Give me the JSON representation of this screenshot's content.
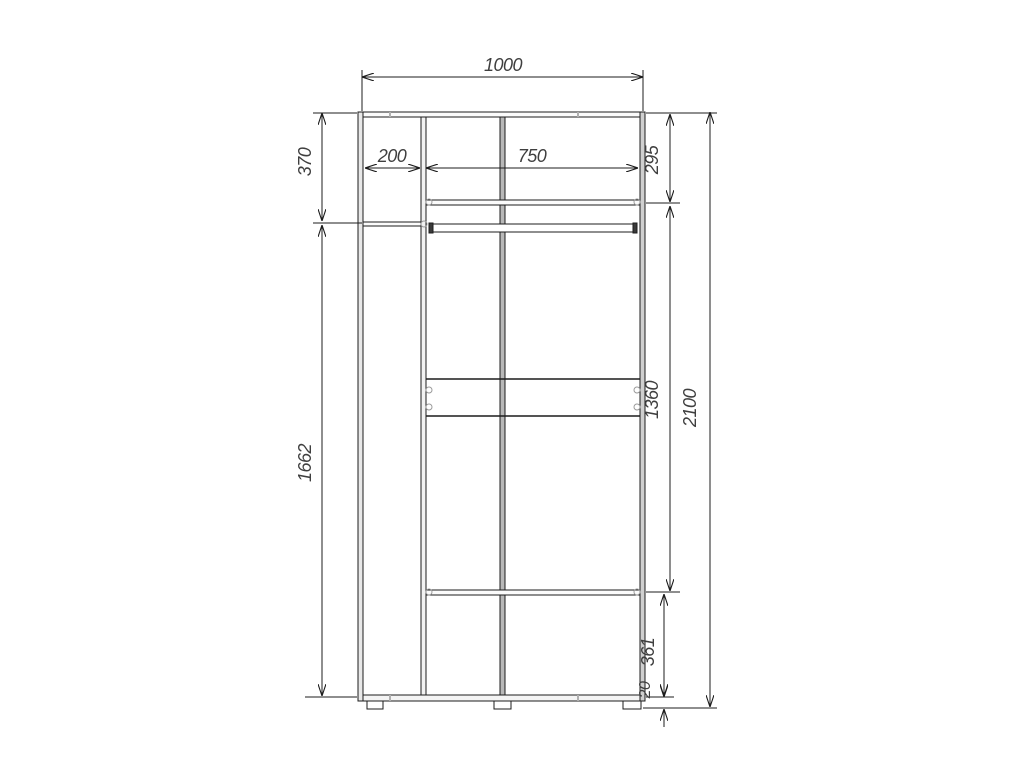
{
  "drawing": {
    "type": "wardrobe-front-section-technical-drawing",
    "dimensions": {
      "width_total": {
        "label": "1000"
      },
      "left_section_width": {
        "label": "200"
      },
      "right_section_width": {
        "label": "750"
      },
      "top_left_height": {
        "label": "370"
      },
      "top_right_height": {
        "label": "295"
      },
      "left_lower_height": {
        "label": "1662"
      },
      "right_middle_height": {
        "label": "1360"
      },
      "bottom_right_height": {
        "label": "361"
      },
      "plinth_height": {
        "label": "20"
      },
      "height_total": {
        "label": "2100"
      }
    },
    "colors": {
      "line": "#1c1c1c",
      "text": "#3f3f3f",
      "panel_gray": "#b8b8b8",
      "wall_gray": "#cfcfcf",
      "connector_gray": "#9a9a9a",
      "background": "#ffffff"
    }
  }
}
